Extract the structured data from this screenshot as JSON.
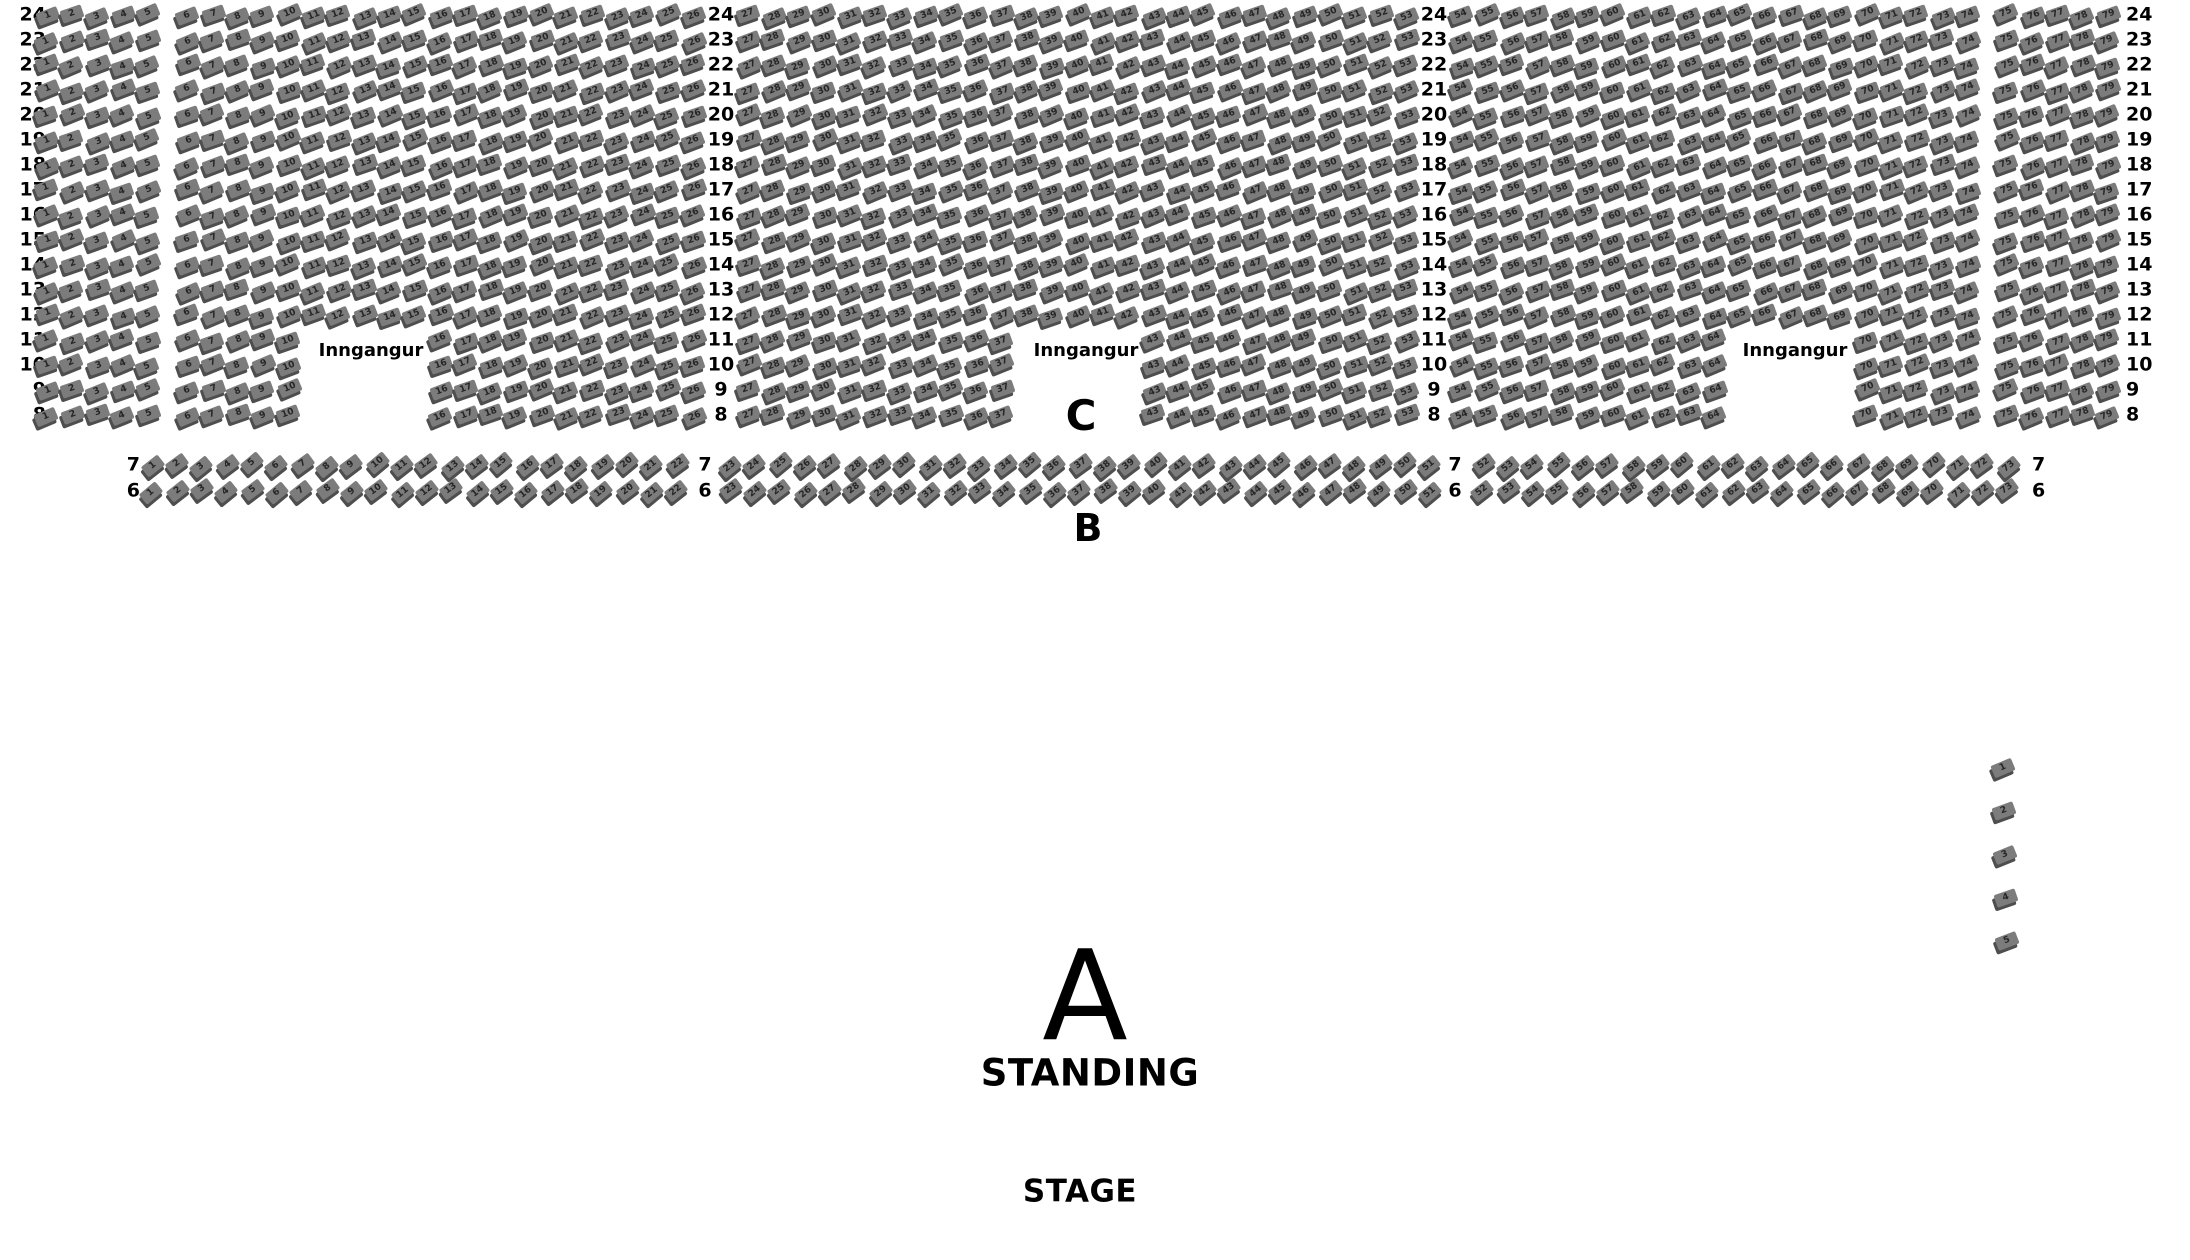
{
  "stage_label": "STAGE",
  "sections": {
    "c": {
      "label": "C",
      "row_numbers": [
        24,
        23,
        22,
        21,
        20,
        19,
        18,
        17,
        16,
        15,
        14,
        13,
        12,
        11,
        10,
        9,
        8
      ],
      "seats_per_row": 79,
      "segments": [
        {
          "from": 1,
          "to": 5
        },
        {
          "from": 6,
          "to": 26
        },
        {
          "from": 27,
          "to": 53
        },
        {
          "from": 54,
          "to": 74
        },
        {
          "from": 75,
          "to": 79
        }
      ],
      "entrance_rows": [
        11,
        10,
        9,
        8
      ],
      "entrance_missing_seats": [
        {
          "from": 11,
          "to": 15
        },
        {
          "from": 38,
          "to": 42
        },
        {
          "from": 65,
          "to": 69
        }
      ],
      "entrances": [
        {
          "label": "Inngangur"
        },
        {
          "label": "Inngangur"
        },
        {
          "label": "Inngangur"
        }
      ]
    },
    "b": {
      "label": "B",
      "row_numbers": [
        7,
        6
      ],
      "seats_per_row": 73,
      "segments": [
        {
          "from": 1,
          "to": 22
        },
        {
          "from": 23,
          "to": 51
        },
        {
          "from": 52,
          "to": 73
        }
      ]
    },
    "a": {
      "label": "A",
      "sublabel": "STANDING"
    },
    "side": {
      "seat_numbers": [
        1,
        2,
        3,
        4,
        5
      ]
    }
  },
  "colors": {
    "background": "#ffffff",
    "seat_fill": "#7c7c7c",
    "seat_shadow": "#4e4e4e",
    "seat_number": "#262626",
    "text": "#000000"
  },
  "layout": {
    "canvas": {
      "width": 2190,
      "height": 1260
    },
    "c": {
      "y_top": 15,
      "row_pitch": 25,
      "base_x": 47,
      "seat_pitch": 25.3,
      "extra_after": {
        "6": 14,
        "27": 30,
        "54": 30,
        "75": 14
      },
      "label_cols": [
        {
          "x": 46,
          "align": "r"
        },
        {
          "x": 721,
          "align": "c"
        },
        {
          "x": 1434,
          "align": "c"
        },
        {
          "x": 2126,
          "align": "l"
        }
      ]
    },
    "b": {
      "rows_y": [
        465,
        491
      ],
      "base_x": 152,
      "seat_pitch": 25,
      "extra_after": {
        "23": 28,
        "52": 28
      },
      "label_cols": [
        {
          "x": 140,
          "align": "r"
        },
        {
          "x": 705,
          "align": "c"
        },
        {
          "x": 1455,
          "align": "c"
        },
        {
          "x": 2032,
          "align": "l"
        }
      ]
    },
    "side": {
      "x": 2003,
      "y_top": 768,
      "pitch": 43.3,
      "x_drift": 1
    },
    "positions": {
      "ent0": {
        "x": 371,
        "y": 351
      },
      "ent1": {
        "x": 1086,
        "y": 351
      },
      "ent2": {
        "x": 1795,
        "y": 351
      },
      "c_label": {
        "x": 1081,
        "y": 416
      },
      "b_label": {
        "x": 1088,
        "y": 528
      },
      "a_label": {
        "x": 1085,
        "y": 997
      },
      "standing_label": {
        "x": 1090,
        "y": 1073
      },
      "stage_label": {
        "x": 1080,
        "y": 1192
      }
    }
  }
}
